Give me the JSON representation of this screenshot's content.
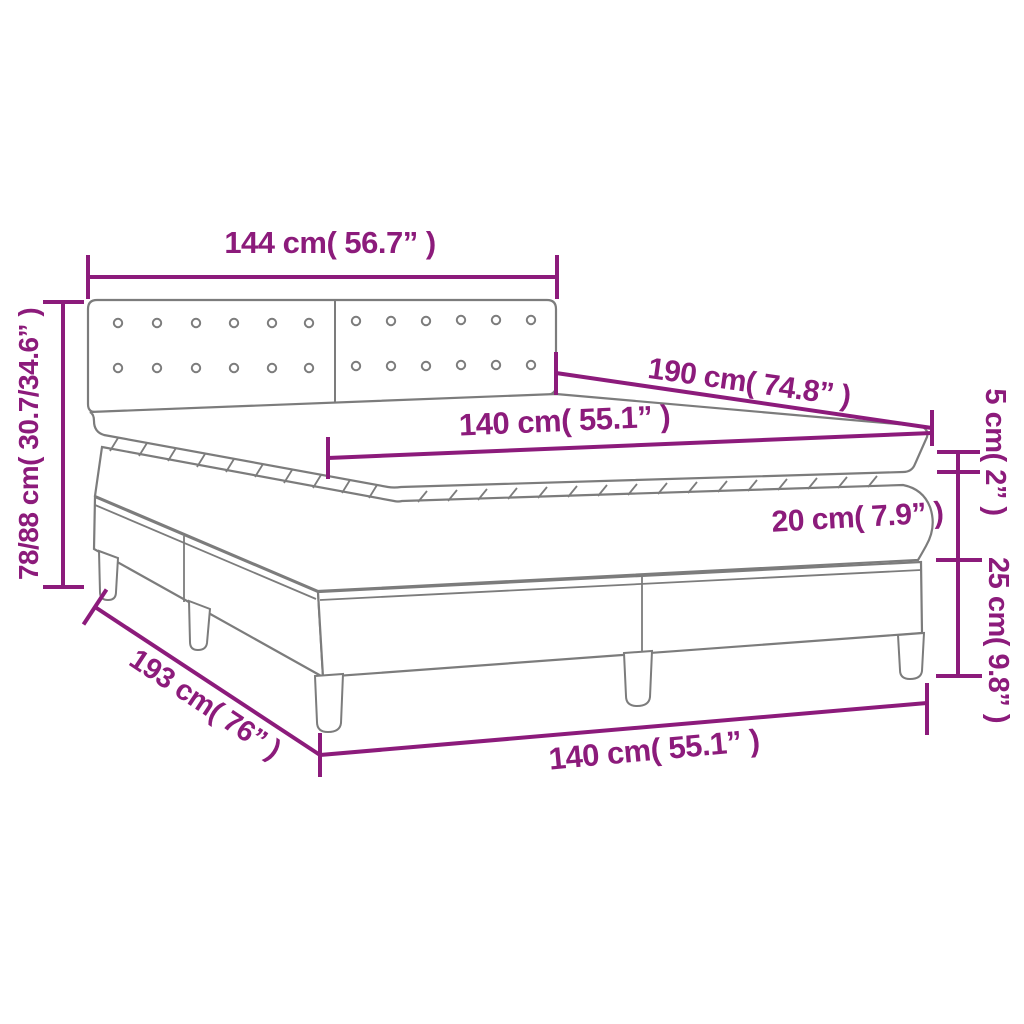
{
  "diagram": {
    "accent_color": "#8C1B7B",
    "outline_color": "#7C7C7C",
    "background_color": "#FFFFFF",
    "labels": {
      "headboard_width": "144 cm( 56.7” )",
      "overall_height": "78/88 cm( 30.7/34.6” )",
      "mattress_length": "190 cm( 74.8” )",
      "mattress_width": "140 cm( 55.1” )",
      "topper_thickness": "5 cm( 2” )",
      "mattress_thickness": "20 cm( 7.9” )",
      "base_height": "25 cm( 9.8” )",
      "base_length": "193 cm( 76” )",
      "base_width": "140 cm( 55.1” )"
    }
  }
}
